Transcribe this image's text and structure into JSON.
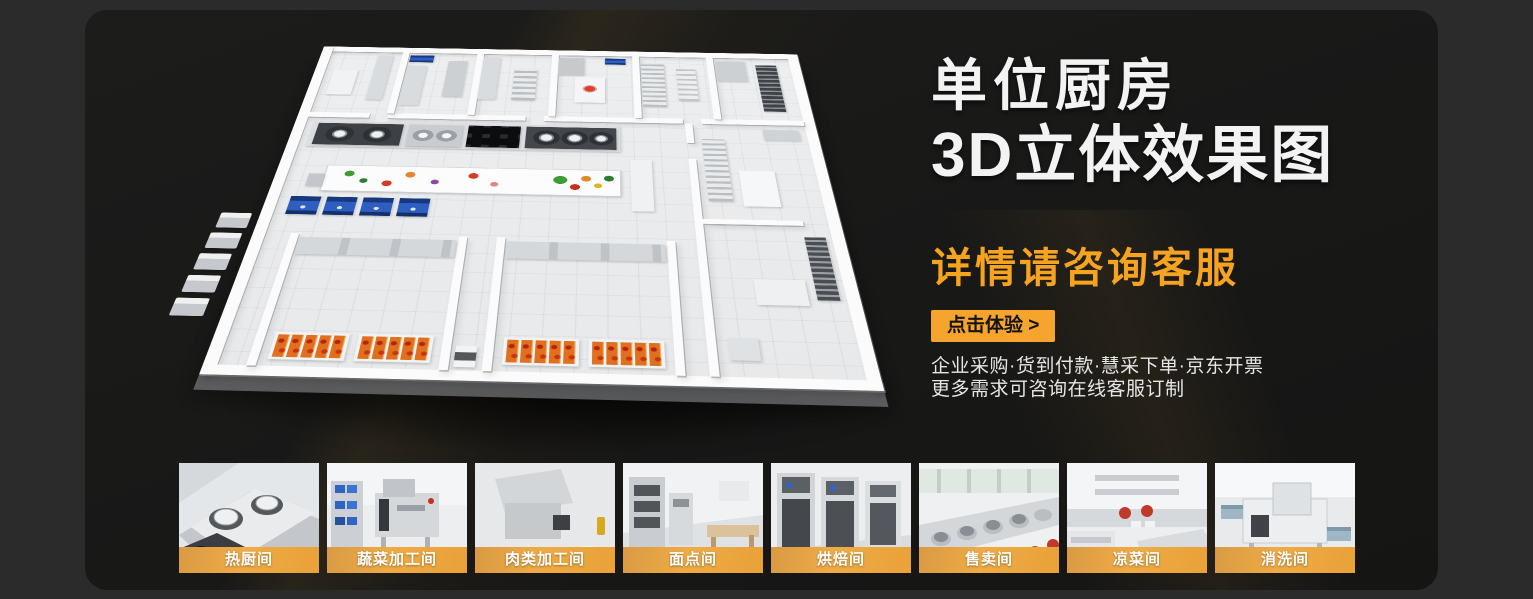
{
  "hero": {
    "title_line1": "单位厨房",
    "title_line2": "3D立体效果图",
    "subtitle": "详情请咨询客服",
    "cta_label": "点击体验 >",
    "benefits_line1": "企业采购·货到付款·慧采下单·京东开票",
    "benefits_line2": "更多需求可咨询在线客服订制",
    "accent_color": "#f5a42e",
    "title_color": "#f3f3f3",
    "background_color": "#1a1a19"
  },
  "gallery": {
    "label_banner_color": "#eda63f",
    "items": [
      {
        "label": "热厨间"
      },
      {
        "label": "蔬菜加工间"
      },
      {
        "label": "肉类加工间"
      },
      {
        "label": "面点间"
      },
      {
        "label": "烘焙间"
      },
      {
        "label": "售卖间"
      },
      {
        "label": "凉菜间"
      },
      {
        "label": "消洗间"
      }
    ]
  }
}
